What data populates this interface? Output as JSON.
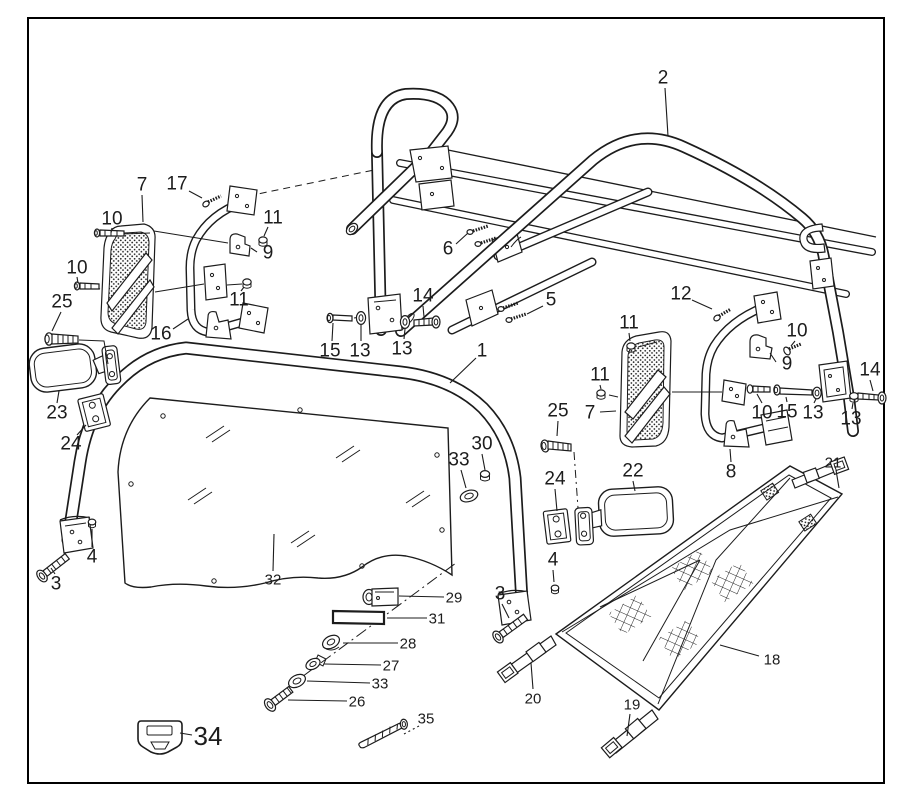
{
  "figure": {
    "background": "#ffffff",
    "border_color": "#000000",
    "line_color": "#1c1c1c",
    "callout_color": "#1c1c1c",
    "callouts": [
      {
        "label": "2",
        "x": 663,
        "y": 78,
        "size": 19,
        "leader": [
          665,
          88,
          668,
          136
        ],
        "style": "solid"
      },
      {
        "label": "7",
        "x": 142,
        "y": 185,
        "size": 19,
        "leader": [
          142,
          195,
          143,
          222
        ],
        "style": "solid"
      },
      {
        "label": "17",
        "x": 177,
        "y": 184,
        "size": 19,
        "leader": [
          189,
          191,
          202,
          198
        ],
        "style": "solid"
      },
      {
        "label": "10",
        "x": 112,
        "y": 219,
        "size": 19,
        "leader": [
          112,
          228,
          111,
          233
        ],
        "style": "solid"
      },
      {
        "label": "11",
        "x": 273,
        "y": 218,
        "size": 19,
        "leader": [
          268,
          227,
          264,
          236
        ],
        "style": "solid"
      },
      {
        "label": "9",
        "x": 268,
        "y": 253,
        "size": 19,
        "leader": [
          257,
          252,
          251,
          248
        ],
        "style": "solid"
      },
      {
        "label": "10",
        "x": 77,
        "y": 268,
        "size": 19,
        "leader": [
          77,
          277,
          78,
          283
        ],
        "style": "solid"
      },
      {
        "label": "25",
        "x": 62,
        "y": 302,
        "size": 19,
        "leader": [
          61,
          312,
          52,
          331
        ],
        "style": "solid"
      },
      {
        "label": "11",
        "x": 239,
        "y": 300,
        "size": 19,
        "leader": [
          241,
          291,
          244,
          287
        ],
        "style": "solid"
      },
      {
        "label": "16",
        "x": 161,
        "y": 334,
        "size": 19,
        "leader": [
          173,
          329,
          188,
          319
        ],
        "style": "solid"
      },
      {
        "label": "6",
        "x": 448,
        "y": 249,
        "size": 19,
        "leader": [
          456,
          244,
          468,
          233
        ],
        "style": "solid"
      },
      {
        "label": "5",
        "x": 551,
        "y": 300,
        "size": 19,
        "leader": [
          543,
          306,
          527,
          314
        ],
        "style": "solid"
      },
      {
        "label": "14",
        "x": 423,
        "y": 296,
        "size": 19,
        "leader": [
          423,
          306,
          424,
          317
        ],
        "style": "solid"
      },
      {
        "label": "15",
        "x": 330,
        "y": 351,
        "size": 19,
        "leader": [
          332,
          341,
          333,
          323
        ],
        "style": "solid"
      },
      {
        "label": "13",
        "x": 360,
        "y": 351,
        "size": 19,
        "leader": [
          361,
          341,
          361,
          325
        ],
        "style": "solid"
      },
      {
        "label": "13",
        "x": 402,
        "y": 349,
        "size": 19,
        "leader": [
          404,
          339,
          405,
          329
        ],
        "style": "solid"
      },
      {
        "label": "1",
        "x": 482,
        "y": 351,
        "size": 19,
        "leader": [
          476,
          358,
          450,
          383
        ],
        "style": "solid"
      },
      {
        "label": "12",
        "x": 681,
        "y": 294,
        "size": 19,
        "leader": [
          692,
          300,
          712,
          309
        ],
        "style": "solid"
      },
      {
        "label": "11",
        "x": 629,
        "y": 323,
        "size": 19,
        "leader": [
          629,
          333,
          630,
          341
        ],
        "style": "solid"
      },
      {
        "label": "10",
        "x": 797,
        "y": 331,
        "size": 19,
        "leader": [
          795,
          341,
          791,
          346
        ],
        "style": "solid"
      },
      {
        "label": "9",
        "x": 787,
        "y": 364,
        "size": 19,
        "leader": [
          776,
          362,
          770,
          353
        ],
        "style": "solid"
      },
      {
        "label": "11",
        "x": 600,
        "y": 375,
        "size": 19,
        "leader": [
          600,
          385,
          601,
          389
        ],
        "style": "solid"
      },
      {
        "label": "14",
        "x": 870,
        "y": 370,
        "size": 19,
        "leader": [
          870,
          380,
          873,
          391
        ],
        "style": "solid"
      },
      {
        "label": "7",
        "x": 590,
        "y": 413,
        "size": 19,
        "leader": [
          600,
          412,
          616,
          411
        ],
        "style": "solid"
      },
      {
        "label": "10",
        "x": 762,
        "y": 413,
        "size": 19,
        "leader": [
          762,
          403,
          757,
          394
        ],
        "style": "solid"
      },
      {
        "label": "15",
        "x": 787,
        "y": 412,
        "size": 19,
        "leader": [
          787,
          402,
          786,
          397
        ],
        "style": "solid"
      },
      {
        "label": "13",
        "x": 813,
        "y": 413,
        "size": 19,
        "leader": [
          814,
          403,
          816,
          399
        ],
        "style": "solid"
      },
      {
        "label": "13",
        "x": 851,
        "y": 419,
        "size": 19,
        "leader": [
          852,
          409,
          853,
          403
        ],
        "style": "solid"
      },
      {
        "label": "25",
        "x": 558,
        "y": 411,
        "size": 19,
        "leader": [
          558,
          421,
          557,
          436
        ],
        "style": "solid"
      },
      {
        "label": "22",
        "x": 633,
        "y": 471,
        "size": 19,
        "leader": [
          633,
          481,
          635,
          491
        ],
        "style": "solid"
      },
      {
        "label": "24",
        "x": 555,
        "y": 479,
        "size": 19,
        "leader": [
          555,
          489,
          557,
          511
        ],
        "style": "solid"
      },
      {
        "label": "8",
        "x": 731,
        "y": 472,
        "size": 19,
        "leader": [
          731,
          462,
          730,
          449
        ],
        "style": "solid"
      },
      {
        "label": "21",
        "x": 833,
        "y": 463,
        "size": 15,
        "leader": [
          836,
          470,
          839,
          488
        ],
        "style": "solid"
      },
      {
        "label": "23",
        "x": 57,
        "y": 413,
        "size": 19,
        "leader": [
          57,
          403,
          59,
          391
        ],
        "style": "solid"
      },
      {
        "label": "24",
        "x": 71,
        "y": 444,
        "size": 19,
        "leader": [
          77,
          435,
          86,
          425
        ],
        "style": "solid"
      },
      {
        "label": "30",
        "x": 482,
        "y": 444,
        "size": 19,
        "leader": [
          482,
          454,
          485,
          470
        ],
        "style": "solid"
      },
      {
        "label": "33",
        "x": 459,
        "y": 460,
        "size": 19,
        "leader": [
          461,
          470,
          466,
          488
        ],
        "style": "solid"
      },
      {
        "label": "4",
        "x": 553,
        "y": 560,
        "size": 19,
        "leader": [
          553,
          570,
          554,
          582
        ],
        "style": "solid"
      },
      {
        "label": "3",
        "x": 500,
        "y": 594,
        "size": 19,
        "leader": [
          502,
          604,
          509,
          618
        ],
        "style": "solid"
      },
      {
        "label": "4",
        "x": 92,
        "y": 557,
        "size": 19,
        "leader": [
          92,
          547,
          92,
          529
        ],
        "style": "solid"
      },
      {
        "label": "3",
        "x": 56,
        "y": 584,
        "size": 19,
        "leader": [
          55,
          574,
          51,
          568
        ],
        "style": "solid"
      },
      {
        "label": "32",
        "x": 273,
        "y": 580,
        "size": 15,
        "leader": [
          273,
          571,
          274,
          534
        ],
        "style": "solid"
      },
      {
        "label": "29",
        "x": 454,
        "y": 598,
        "size": 15,
        "leader": [
          444,
          597,
          399,
          596
        ],
        "style": "solid"
      },
      {
        "label": "31",
        "x": 437,
        "y": 619,
        "size": 15,
        "leader": [
          427,
          618,
          387,
          618
        ],
        "style": "solid"
      },
      {
        "label": "28",
        "x": 408,
        "y": 644,
        "size": 15,
        "leader": [
          398,
          643,
          343,
          643
        ],
        "style": "solid"
      },
      {
        "label": "27",
        "x": 391,
        "y": 666,
        "size": 15,
        "leader": [
          381,
          665,
          324,
          664
        ],
        "style": "solid"
      },
      {
        "label": "33",
        "x": 380,
        "y": 684,
        "size": 15,
        "leader": [
          370,
          683,
          307,
          681
        ],
        "style": "solid"
      },
      {
        "label": "26",
        "x": 357,
        "y": 702,
        "size": 15,
        "leader": [
          347,
          701,
          288,
          700
        ],
        "style": "solid"
      },
      {
        "label": "35",
        "x": 426,
        "y": 719,
        "size": 15,
        "leader": [
          419,
          726,
          404,
          734
        ],
        "style": "dotted"
      },
      {
        "label": "34",
        "x": 208,
        "y": 736,
        "size": 26,
        "leader": [
          192,
          735,
          180,
          733
        ],
        "style": "solid"
      },
      {
        "label": "18",
        "x": 772,
        "y": 660,
        "size": 15,
        "leader": [
          759,
          656,
          720,
          645
        ],
        "style": "solid"
      },
      {
        "label": "20",
        "x": 533,
        "y": 699,
        "size": 15,
        "leader": [
          533,
          689,
          531,
          663
        ],
        "style": "solid"
      },
      {
        "label": "19",
        "x": 632,
        "y": 705,
        "size": 15,
        "leader": [
          630,
          714,
          627,
          736
        ],
        "style": "solid"
      }
    ]
  }
}
